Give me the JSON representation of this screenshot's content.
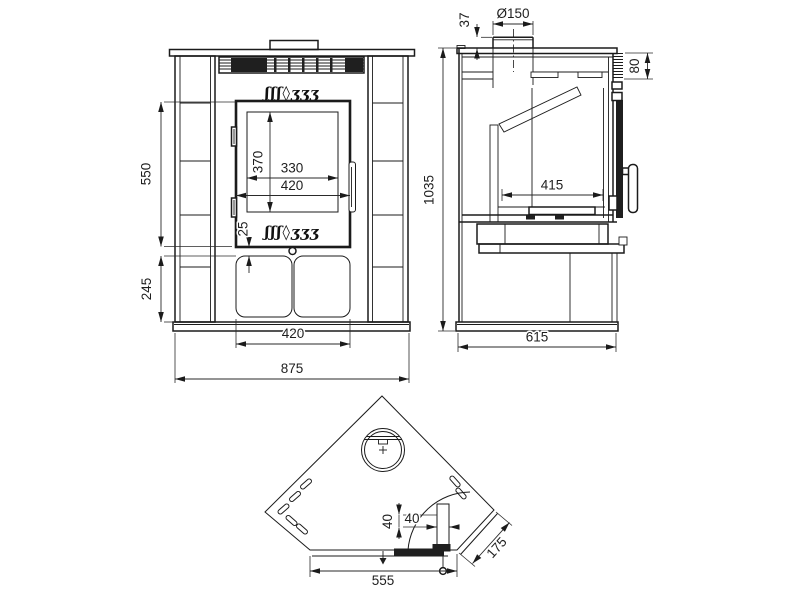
{
  "drawing": {
    "background": "#ffffff",
    "line_color": "#1b1b1b",
    "brand_logo_glyphs": "ʃʃʃ◊ʒʒʒ",
    "front_view": {
      "dim_550": "550",
      "dim_245": "245",
      "dim_370": "370",
      "dim_330": "330",
      "dim_420_door": "420",
      "dim_25": "25",
      "dim_420_base": "420",
      "dim_875": "875"
    },
    "side_view": {
      "dim_37": "37",
      "dim_flue": "Ø150",
      "dim_80": "80",
      "dim_1035": "1035",
      "dim_415": "415",
      "dim_615": "615"
    },
    "top_view": {
      "dim_40_a": "40",
      "dim_40_b": "40",
      "dim_175": "175",
      "dim_555": "555"
    }
  }
}
